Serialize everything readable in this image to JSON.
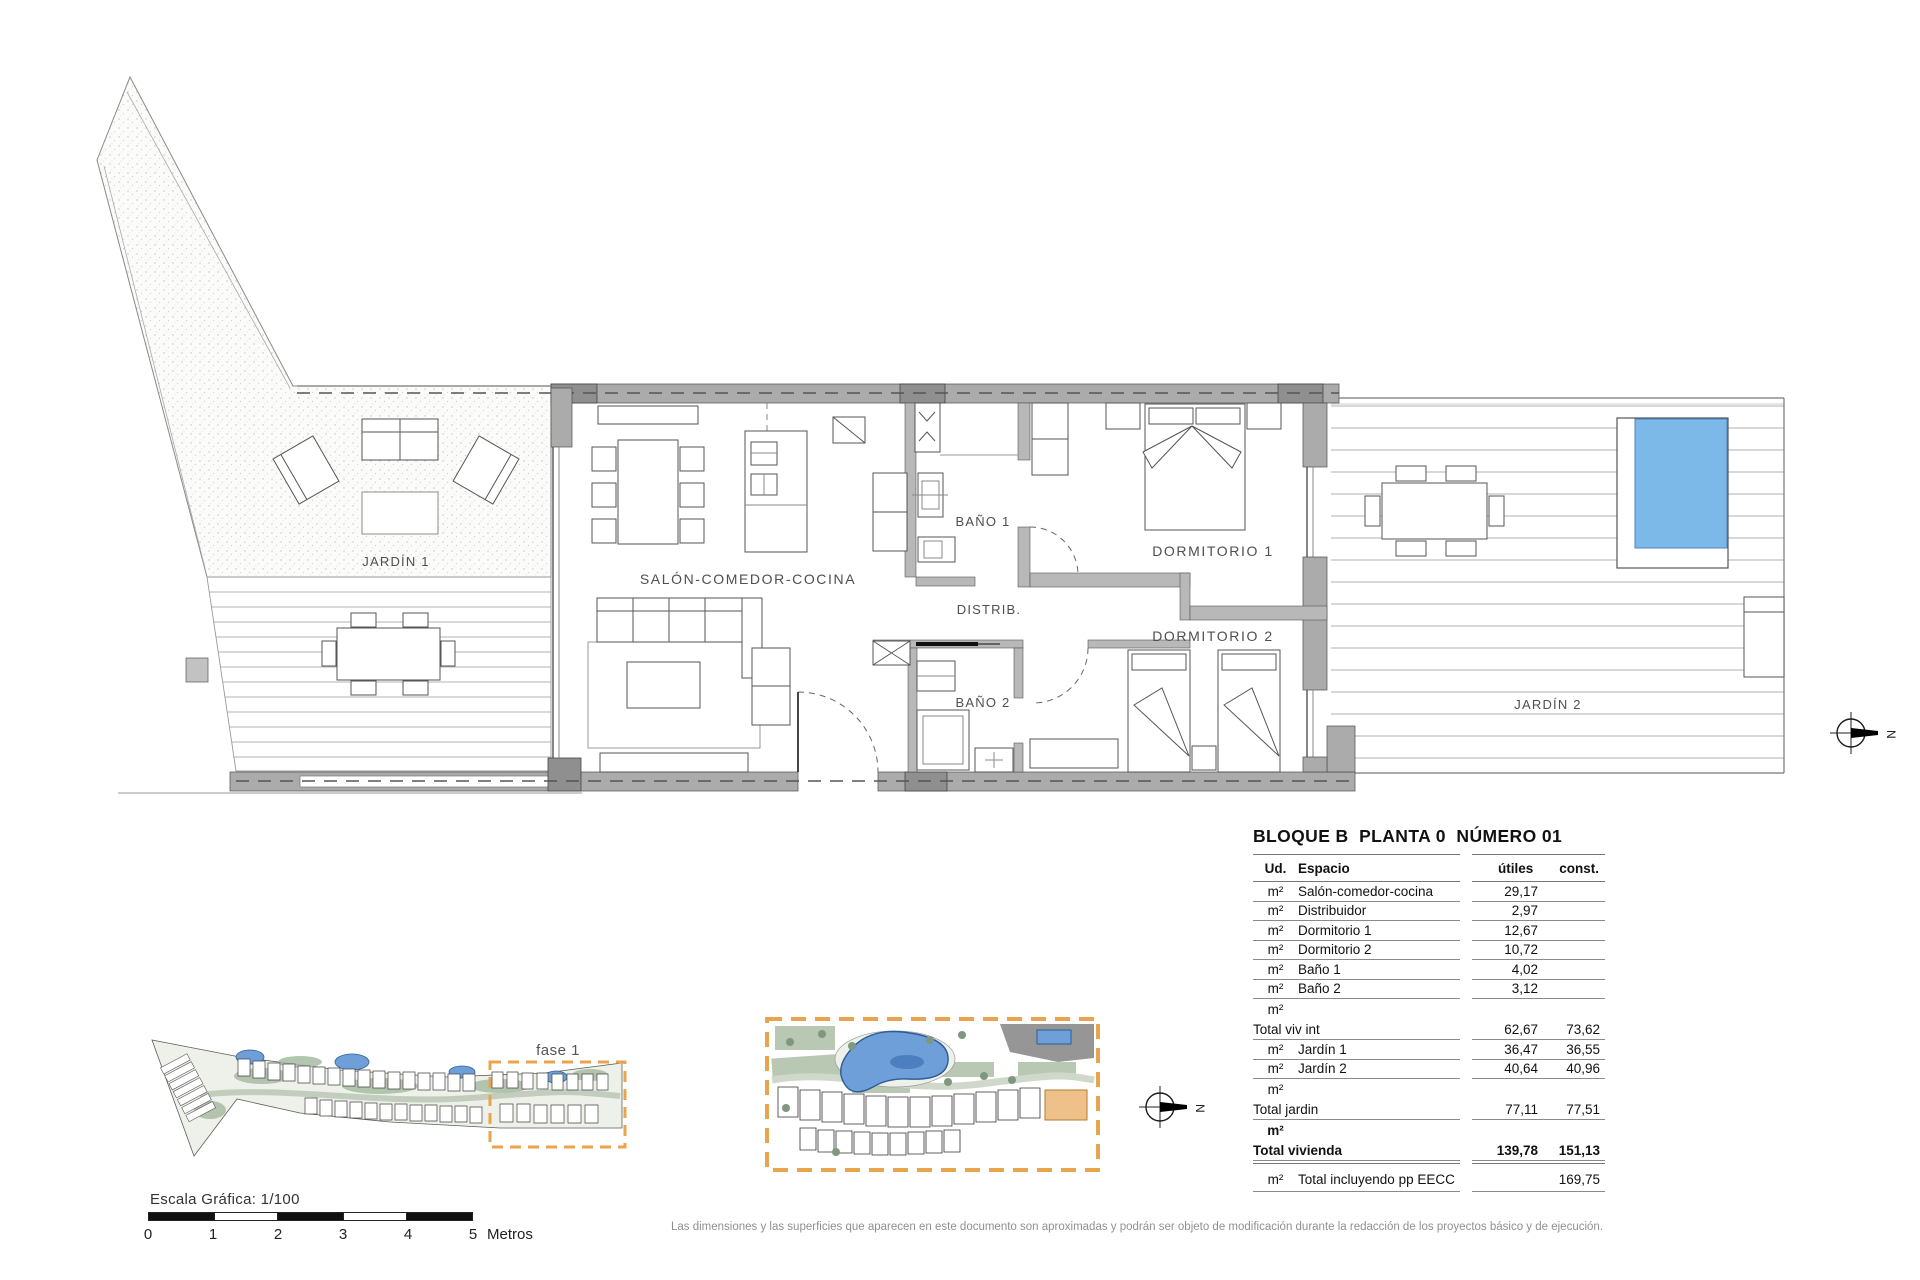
{
  "plan": {
    "rooms": [
      {
        "id": "jardin1",
        "label": "JARDÍN 1"
      },
      {
        "id": "salon",
        "label": "SALÓN-COMEDOR-COCINA"
      },
      {
        "id": "bano1",
        "label": "BAÑO 1"
      },
      {
        "id": "distrib",
        "label": "DISTRIB."
      },
      {
        "id": "bano2",
        "label": "BAÑO 2"
      },
      {
        "id": "dorm1",
        "label": "DORMITORIO 1"
      },
      {
        "id": "dorm2",
        "label": "DORMITORIO 2"
      },
      {
        "id": "jardin2",
        "label": "JARDÍN 2"
      }
    ],
    "compass_letter": "N"
  },
  "summary_table": {
    "title": "BLOQUE B  PLANTA 0  NÚMERO 01",
    "columns": {
      "ud": "Ud.",
      "espacio": "Espacio",
      "utiles": "útiles",
      "const": "const."
    },
    "rows": [
      {
        "ud": "m²",
        "espacio": "Salón-comedor-cocina",
        "utiles": "29,17",
        "const": ""
      },
      {
        "ud": "m²",
        "espacio": "Distribuidor",
        "utiles": "2,97",
        "const": ""
      },
      {
        "ud": "m²",
        "espacio": "Dormitorio 1",
        "utiles": "12,67",
        "const": ""
      },
      {
        "ud": "m²",
        "espacio": "Dormitorio 2",
        "utiles": "10,72",
        "const": ""
      },
      {
        "ud": "m²",
        "espacio": "Baño 1",
        "utiles": "4,02",
        "const": ""
      },
      {
        "ud": "m²",
        "espacio": "Baño 2",
        "utiles": "3,12",
        "const": ""
      },
      {
        "ud": "m²",
        "espacio": "Total viv int",
        "utiles": "62,67",
        "const": "73,62",
        "total": true
      },
      {
        "ud": "m²",
        "espacio": "Jardín 1",
        "utiles": "36,47",
        "const": "36,55"
      },
      {
        "ud": "m²",
        "espacio": "Jardín 2",
        "utiles": "40,64",
        "const": "40,96"
      },
      {
        "ud": "m²",
        "espacio": "Total jardin",
        "utiles": "77,11",
        "const": "77,51",
        "total": true
      },
      {
        "ud": "m²",
        "espacio": "Total vivienda",
        "utiles": "139,78",
        "const": "151,13",
        "total": true,
        "bold": true,
        "extra_rule": true
      },
      {
        "ud": "m²",
        "espacio": "Total incluyendo pp EECC",
        "utiles": "",
        "const": "169,75",
        "last": true
      }
    ]
  },
  "site_plans": {
    "fase_label": "fase 1"
  },
  "scale_bar": {
    "label": "Escala Gráfica:  1/100",
    "ticks": [
      "0",
      "1",
      "2",
      "3",
      "4",
      "5"
    ],
    "unit": "Metros"
  },
  "disclaimer": "Las dimensiones y las superficies que aparecen en este documento son aproximadas y podrán ser objeto de modificación durante la redacción de los proyectos básico y de ejecución.",
  "colors": {
    "accent_orange": "#e8a54e",
    "pool_blue": "#7db9e8",
    "pool_blue_dark": "#4c86c0",
    "site_pool_blue": "#6f9fd8",
    "wall_gray": "#ababab",
    "pillar_gray": "#8f8f8f",
    "deck_line": "#b3b3b3"
  }
}
